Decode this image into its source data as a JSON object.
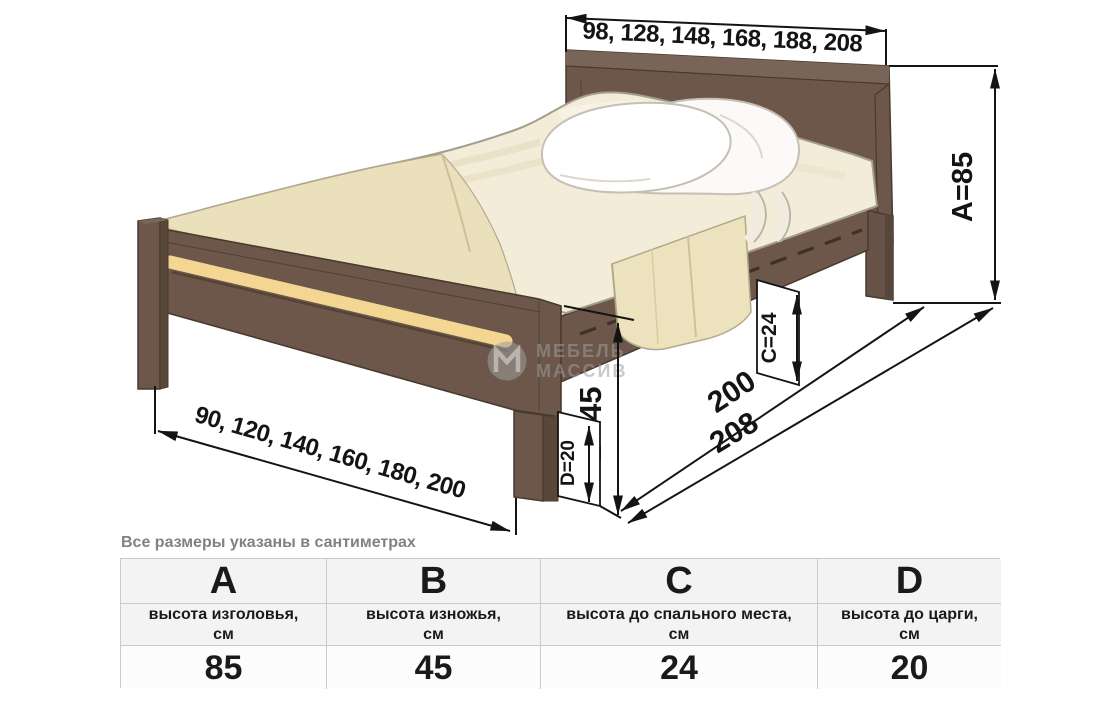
{
  "diagram": {
    "top_widths": "98, 128, 148, 168, 188, 208",
    "bottom_widths": "90, 120, 140, 160, 180, 200",
    "dim_a": "A=85",
    "dim_b": "B=45",
    "dim_c": "C=24",
    "dim_d": "D=20",
    "length_inner": "200",
    "length_outer": "208",
    "watermark": {
      "line1": "МЕБЕЛЬ",
      "line2": "МАССИВ"
    },
    "colors": {
      "wood_brown": "#6C574A",
      "wood_brown_dark": "#594739",
      "wood_outline": "#493A2E",
      "accent_stripe": "#F2D692",
      "mattress": "#F2ECD8",
      "blanket": "#EBE0BC",
      "pillow": "#FFFFFF",
      "dimension_ink": "#141414",
      "watermark_gray": "#9F9F9F",
      "table_border": "#CBCBCB",
      "table_header_bg": "#F3F3F3",
      "caption_gray": "#828282"
    }
  },
  "caption": {
    "text": "Все размеры указаны в сантиметрах"
  },
  "table": {
    "columns": [
      {
        "letter": "A",
        "description": "высота изголовья,",
        "unit": "см",
        "value": "85"
      },
      {
        "letter": "B",
        "description": "высота изножья,",
        "unit": "см",
        "value": "45"
      },
      {
        "letter": "C",
        "description": "высота до спального места,",
        "unit": "см",
        "value": "24"
      },
      {
        "letter": "D",
        "description": "высота до царги,",
        "unit": "см",
        "value": "20"
      }
    ]
  }
}
